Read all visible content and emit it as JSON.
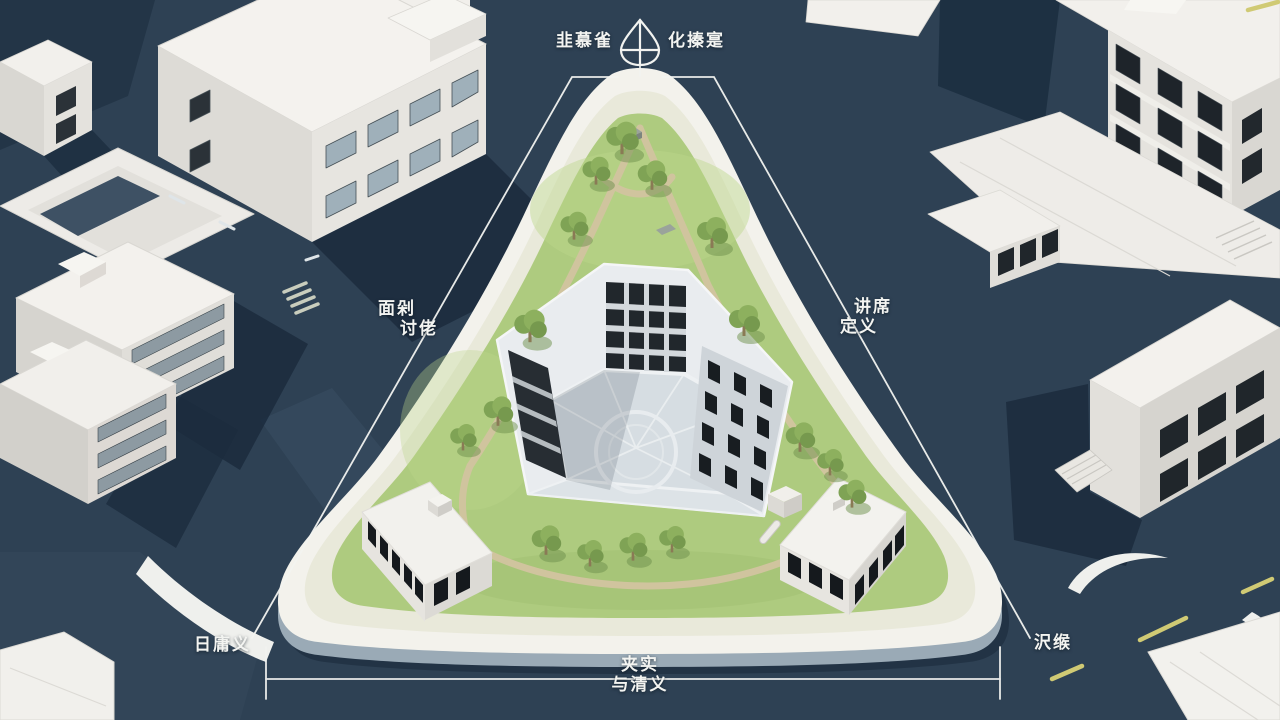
{
  "annotations": {
    "top_left": "韭慕雀",
    "top_right": "化搸寔",
    "left": {
      "line1": "面剁",
      "line2": "讨佬"
    },
    "right": {
      "line1": "讲席",
      "line2": "定义"
    },
    "bottom_left": "日庸义",
    "bottom_right": "沢缑",
    "bottom_center": {
      "line1": "夹实",
      "line2": "与清义"
    }
  },
  "icons": {
    "north_compass": "north-arrow-compass"
  },
  "colors": {
    "road_navy": "#2e4154",
    "shadow_dark": "#1b2c3d",
    "building_white": "#f3f1ed",
    "window_dark": "#1f252a",
    "window_glass": "#9fb0ba",
    "site_curb": "#f3f2ec",
    "lawn_green": "#aecb7f",
    "path_tan": "#d2c4a0",
    "courtyard_paving": "#d6dde2",
    "dimension_line": "#f2f3f0",
    "lane_yellow": "#d0ca74"
  }
}
